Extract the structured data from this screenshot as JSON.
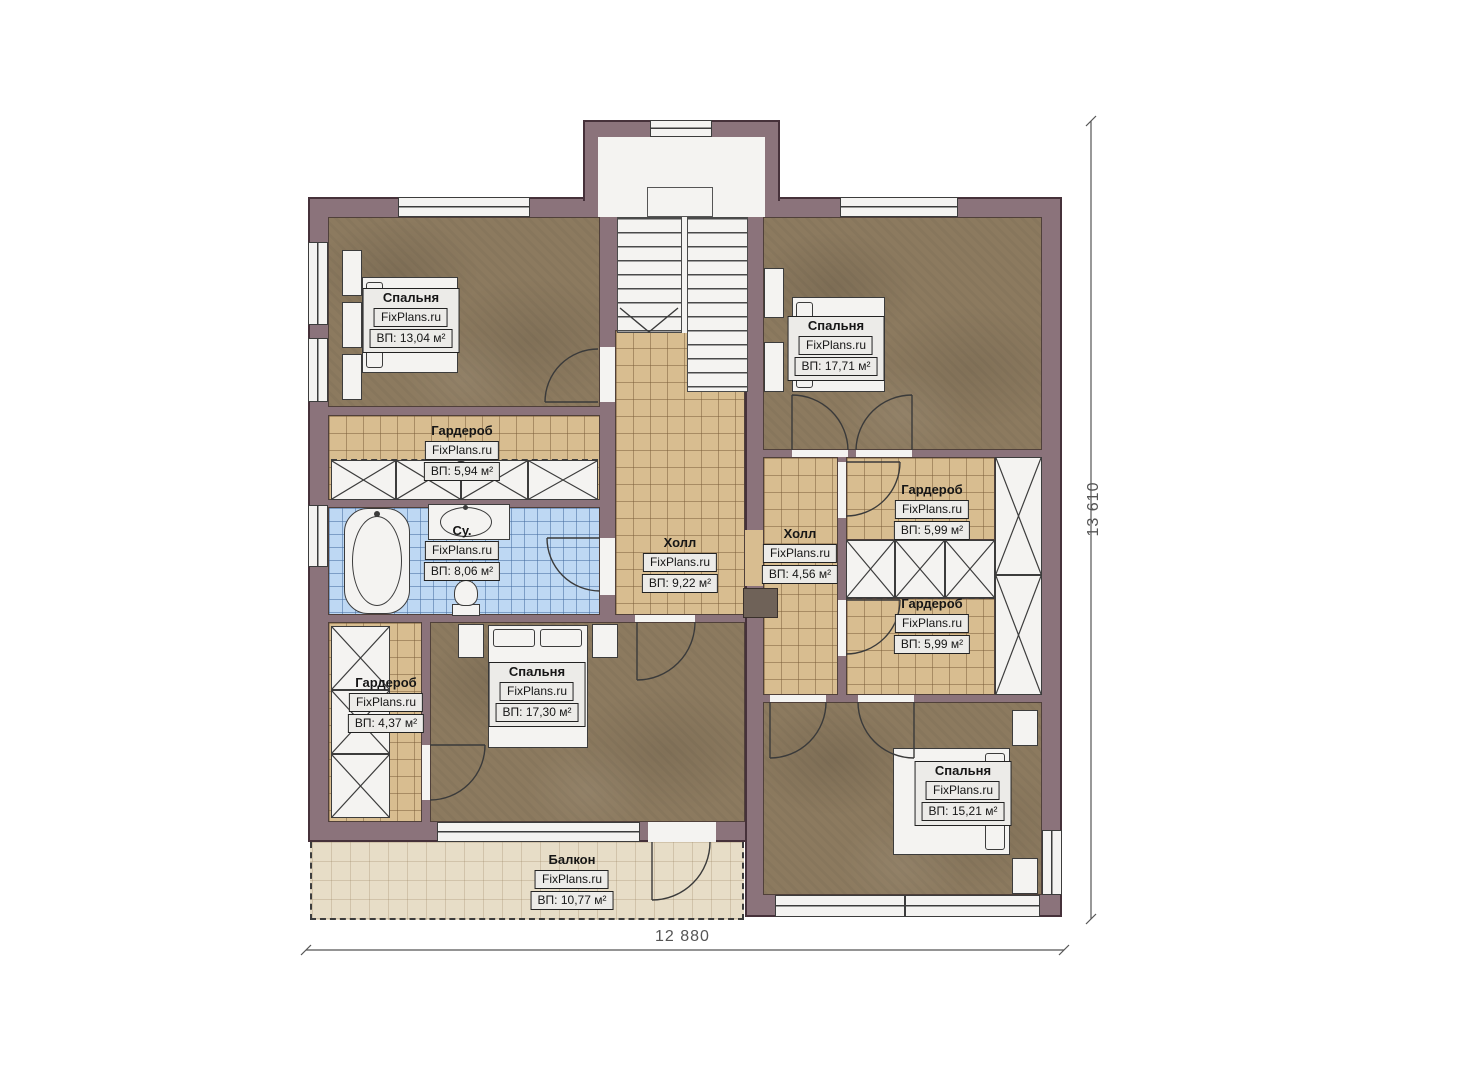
{
  "site_watermark": "FixPlans.ru",
  "rooms": [
    {
      "id": "bedroom-top-left",
      "name": "Спальня",
      "brand": "FixPlans.ru",
      "area": "ВП: 13,04 м²"
    },
    {
      "id": "wardrobe-top",
      "name": "Гардероб",
      "brand": "FixPlans.ru",
      "area": "ВП: 5,94 м²"
    },
    {
      "id": "bathroom",
      "name": "Су.",
      "brand": "FixPlans.ru",
      "area": "ВП: 8,06 м²"
    },
    {
      "id": "wardrobe-left",
      "name": "Гардероб",
      "brand": "FixPlans.ru",
      "area": "ВП: 4,37 м²"
    },
    {
      "id": "bedroom-bottom-center",
      "name": "Спальня",
      "brand": "FixPlans.ru",
      "area": "ВП: 17,30 м²"
    },
    {
      "id": "hall-center",
      "name": "Холл",
      "brand": "FixPlans.ru",
      "area": "ВП: 9,22 м²"
    },
    {
      "id": "bedroom-top-right",
      "name": "Спальня",
      "brand": "FixPlans.ru",
      "area": "ВП: 17,71 м²"
    },
    {
      "id": "hall-right",
      "name": "Холл",
      "brand": "FixPlans.ru",
      "area": "ВП: 4,56 м²"
    },
    {
      "id": "wardrobe-right-upper",
      "name": "Гардероб",
      "brand": "FixPlans.ru",
      "area": "ВП: 5,99 м²"
    },
    {
      "id": "wardrobe-right-lower",
      "name": "Гардероб",
      "brand": "FixPlans.ru",
      "area": "ВП: 5,99 м²"
    },
    {
      "id": "bedroom-bottom-right",
      "name": "Спальня",
      "brand": "FixPlans.ru",
      "area": "ВП: 15,21 м²"
    },
    {
      "id": "balcony",
      "name": "Балкон",
      "brand": "FixPlans.ru",
      "area": "ВП: 10,77 м²"
    }
  ],
  "dimensions": {
    "width": "12 880",
    "height": "13 610"
  },
  "colors": {
    "wall": "#8b737b",
    "wall_edge": "#46313a",
    "wood_floor": "#8c7a5f",
    "tile_floor": "#d8bd90",
    "bath_floor": "#bed8f3",
    "balcony_floor": "#e7ddc7",
    "fixture_white": "#f4f3f1",
    "label_bg": "#ecebe8"
  }
}
